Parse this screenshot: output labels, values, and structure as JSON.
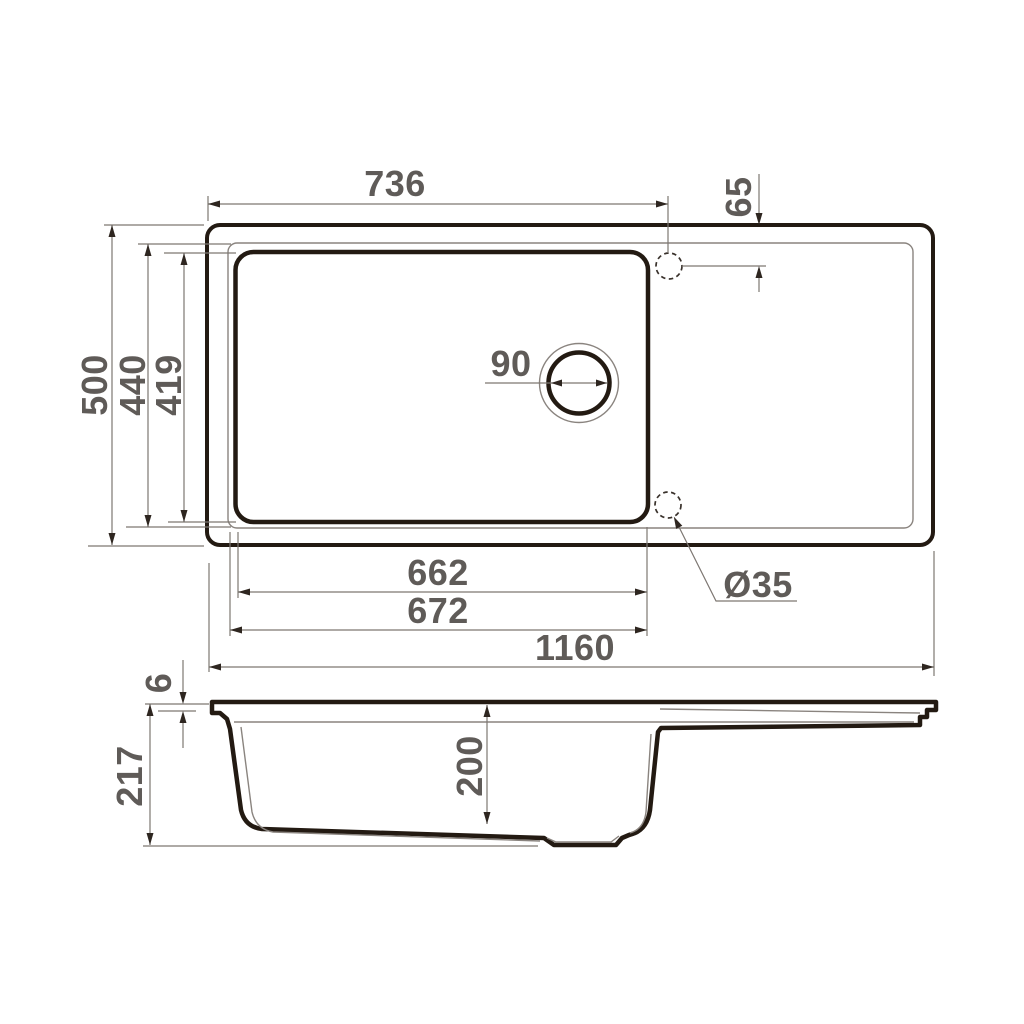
{
  "drawing": {
    "dims": {
      "top_width_to_hole": "736",
      "hole_offset": "65",
      "overall_depth": "500",
      "rim_depth": "440",
      "bowl_depth_plan": "419",
      "drain_diameter": "90",
      "bowl_width_inner": "662",
      "bowl_width_outer": "672",
      "overall_length": "1160",
      "hole_diameter": "Ø35",
      "rim_height": "6",
      "overall_height": "217",
      "bowl_depth_section": "200"
    },
    "colors": {
      "background": "#ffffff",
      "outline": "#231a12",
      "thin_line": "#8a847f",
      "dim_line": "#7d7772",
      "arrowhead": "#2e2620",
      "text": "#5f5b58"
    }
  }
}
